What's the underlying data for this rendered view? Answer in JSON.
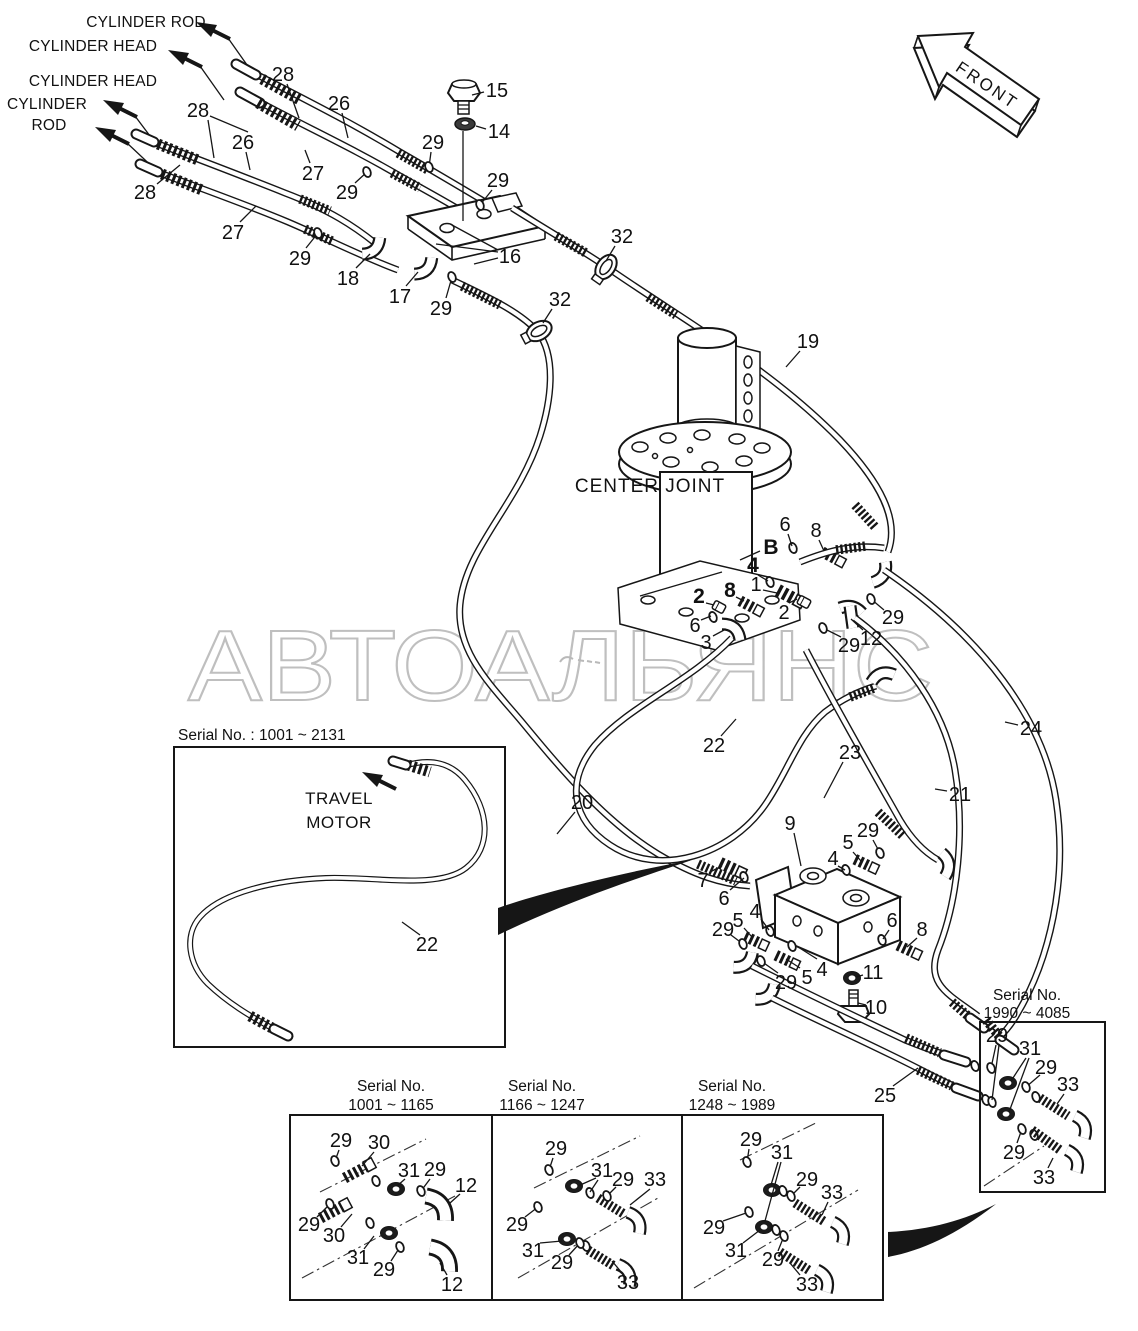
{
  "watermark": {
    "text": "АВТОАЛЬЯНС",
    "color": "#bfbfbf"
  },
  "front_arrow": {
    "label": "FRONT"
  },
  "labels": {
    "center_joint": "CENTER JOINT",
    "travel_motor_1": "TRAVEL",
    "travel_motor_2": "MOTOR",
    "cyl_top_1": "CYLINDER ROD",
    "cyl_top_2": "CYLINDER HEAD",
    "cyl_left_1": "CYLINDER HEAD",
    "cyl_left_2": "CYLINDER",
    "cyl_left_3": "ROD"
  },
  "insets": {
    "travel": {
      "title": "Serial No. : 1001 ~ 2131"
    },
    "box1": {
      "title_1": "Serial No.",
      "title_2": "1001 ~ 1165"
    },
    "box2": {
      "title_1": "Serial No.",
      "title_2": "1166 ~ 1247"
    },
    "box3": {
      "title_1": "Serial No.",
      "title_2": "1248 ~ 1989"
    },
    "box4": {
      "title_1": "Serial No.",
      "title_2": "1990 ~ 4085"
    }
  },
  "callouts": [
    {
      "t": "28",
      "x": 283,
      "y": 74,
      "l": [
        [
          287,
          84,
          299,
          118
        ]
      ]
    },
    {
      "t": "26",
      "x": 339,
      "y": 103,
      "l": [
        [
          342,
          113,
          348,
          138
        ]
      ]
    },
    {
      "t": "15",
      "x": 497,
      "y": 90,
      "l": [
        [
          484,
          92,
          472,
          95
        ]
      ]
    },
    {
      "t": "14",
      "x": 499,
      "y": 131,
      "l": [
        [
          486,
          129,
          476,
          126
        ]
      ]
    },
    {
      "t": "29",
      "x": 433,
      "y": 142,
      "l": [
        [
          431,
          152,
          429,
          167
        ]
      ]
    },
    {
      "t": "28",
      "x": 198,
      "y": 110,
      "l": [
        [
          210,
          116,
          248,
          132
        ],
        [
          208,
          120,
          214,
          158
        ]
      ]
    },
    {
      "t": "26",
      "x": 243,
      "y": 142,
      "l": [
        [
          246,
          152,
          250,
          170
        ]
      ]
    },
    {
      "t": "27",
      "x": 313,
      "y": 173,
      "l": [
        [
          310,
          163,
          305,
          150
        ]
      ]
    },
    {
      "t": "29",
      "x": 347,
      "y": 192,
      "l": [
        [
          355,
          183,
          367,
          172
        ]
      ]
    },
    {
      "t": "29",
      "x": 498,
      "y": 180,
      "l": [
        [
          492,
          190,
          480,
          205
        ]
      ]
    },
    {
      "t": "28",
      "x": 145,
      "y": 192,
      "l": [
        [
          157,
          184,
          180,
          165
        ]
      ]
    },
    {
      "t": "27",
      "x": 233,
      "y": 232,
      "l": [
        [
          240,
          222,
          256,
          206
        ]
      ]
    },
    {
      "t": "29",
      "x": 300,
      "y": 258,
      "l": [
        [
          306,
          248,
          318,
          233
        ]
      ]
    },
    {
      "t": "16",
      "x": 510,
      "y": 256,
      "l": [
        [
          498,
          250,
          452,
          225
        ],
        [
          498,
          252,
          436,
          244
        ],
        [
          498,
          258,
          474,
          264
        ]
      ]
    },
    {
      "t": "18",
      "x": 348,
      "y": 278,
      "l": [
        [
          356,
          268,
          370,
          254
        ]
      ]
    },
    {
      "t": "17",
      "x": 400,
      "y": 296,
      "l": [
        [
          406,
          286,
          418,
          272
        ]
      ]
    },
    {
      "t": "29",
      "x": 441,
      "y": 308,
      "l": [
        [
          446,
          298,
          452,
          277
        ]
      ]
    },
    {
      "t": "32",
      "x": 622,
      "y": 236,
      "l": [
        [
          615,
          246,
          606,
          261
        ]
      ]
    },
    {
      "t": "32",
      "x": 560,
      "y": 299,
      "l": [
        [
          552,
          309,
          543,
          323
        ]
      ]
    },
    {
      "t": "19",
      "x": 808,
      "y": 341,
      "l": [
        [
          800,
          351,
          786,
          367
        ]
      ]
    },
    {
      "t": "6",
      "x": 785,
      "y": 524,
      "l": [
        [
          788,
          534,
          792,
          546
        ]
      ]
    },
    {
      "t": "8",
      "x": 816,
      "y": 530,
      "l": [
        [
          819,
          540,
          824,
          551
        ]
      ]
    },
    {
      "t": "B",
      "x": 771,
      "y": 547,
      "b": 1,
      "l": [
        [
          760,
          551,
          740,
          560
        ]
      ]
    },
    {
      "t": "4",
      "x": 753,
      "y": 565,
      "b": 1,
      "l": [
        [
          758,
          575,
          768,
          581
        ]
      ]
    },
    {
      "t": "1",
      "x": 756,
      "y": 584,
      "l": [
        [
          763,
          590,
          777,
          593
        ]
      ]
    },
    {
      "t": "2",
      "x": 784,
      "y": 612,
      "l": [
        [
          789,
          603,
          797,
          599
        ]
      ]
    },
    {
      "t": "8",
      "x": 730,
      "y": 590,
      "b": 1,
      "l": [
        [
          736,
          597,
          744,
          601
        ]
      ]
    },
    {
      "t": "2",
      "x": 699,
      "y": 596,
      "b": 1,
      "l": [
        [
          706,
          603,
          714,
          605
        ]
      ]
    },
    {
      "t": "6",
      "x": 695,
      "y": 625,
      "l": [
        [
          701,
          620,
          711,
          616
        ]
      ]
    },
    {
      "t": "3",
      "x": 706,
      "y": 642,
      "l": [
        [
          713,
          636,
          726,
          629
        ]
      ]
    },
    {
      "t": "29",
      "x": 893,
      "y": 617,
      "l": [
        [
          884,
          610,
          871,
          599
        ]
      ]
    },
    {
      "t": "12",
      "x": 871,
      "y": 638,
      "l": [
        [
          863,
          630,
          851,
          619
        ]
      ]
    },
    {
      "t": "29",
      "x": 849,
      "y": 645,
      "l": [
        [
          841,
          637,
          823,
          628
        ]
      ]
    },
    {
      "t": "24",
      "x": 1031,
      "y": 728,
      "l": [
        [
          1018,
          725,
          1005,
          722
        ]
      ]
    },
    {
      "t": "21",
      "x": 960,
      "y": 794,
      "l": [
        [
          947,
          791,
          935,
          789
        ]
      ]
    },
    {
      "t": "23",
      "x": 850,
      "y": 752,
      "l": [
        [
          843,
          762,
          824,
          798
        ]
      ]
    },
    {
      "t": "22",
      "x": 714,
      "y": 745,
      "l": [
        [
          721,
          736,
          736,
          719
        ]
      ]
    },
    {
      "t": "20",
      "x": 582,
      "y": 802,
      "l": [
        [
          575,
          812,
          557,
          834
        ]
      ]
    },
    {
      "t": "9",
      "x": 790,
      "y": 823,
      "l": [
        [
          794,
          833,
          801,
          866
        ]
      ]
    },
    {
      "t": "29",
      "x": 868,
      "y": 830,
      "l": [
        [
          873,
          840,
          880,
          853
        ]
      ]
    },
    {
      "t": "5",
      "x": 848,
      "y": 842,
      "l": [
        [
          853,
          852,
          861,
          861
        ]
      ]
    },
    {
      "t": "4",
      "x": 833,
      "y": 858,
      "l": [
        [
          838,
          866,
          845,
          870
        ]
      ]
    },
    {
      "t": "7",
      "x": 703,
      "y": 880,
      "l": [
        [
          710,
          872,
          722,
          866
        ]
      ]
    },
    {
      "t": "6",
      "x": 724,
      "y": 898,
      "l": [
        [
          730,
          890,
          744,
          878
        ]
      ]
    },
    {
      "t": "29",
      "x": 723,
      "y": 929,
      "l": [
        [
          731,
          935,
          743,
          944
        ]
      ]
    },
    {
      "t": "5",
      "x": 738,
      "y": 920,
      "l": [
        [
          744,
          928,
          752,
          937
        ]
      ]
    },
    {
      "t": "4",
      "x": 755,
      "y": 911,
      "l": [
        [
          761,
          919,
          769,
          930
        ]
      ]
    },
    {
      "t": "4",
      "x": 822,
      "y": 969,
      "l": [
        [
          817,
          959,
          798,
          947
        ]
      ]
    },
    {
      "t": "5",
      "x": 807,
      "y": 977,
      "l": [
        [
          800,
          968,
          786,
          959
        ]
      ]
    },
    {
      "t": "29",
      "x": 786,
      "y": 982,
      "l": [
        [
          778,
          973,
          761,
          961
        ]
      ]
    },
    {
      "t": "6",
      "x": 892,
      "y": 920,
      "l": [
        [
          889,
          930,
          883,
          939
        ]
      ]
    },
    {
      "t": "8",
      "x": 922,
      "y": 929,
      "l": [
        [
          917,
          938,
          907,
          947
        ]
      ]
    },
    {
      "t": "11",
      "x": 873,
      "y": 972,
      "l": [
        [
          863,
          975,
          856,
          977
        ]
      ]
    },
    {
      "t": "10",
      "x": 876,
      "y": 1007,
      "l": [
        [
          866,
          1005,
          858,
          1003
        ]
      ]
    },
    {
      "t": "25",
      "x": 885,
      "y": 1095,
      "l": [
        [
          893,
          1086,
          918,
          1068
        ]
      ]
    },
    {
      "t": "22",
      "x": 427,
      "y": 944,
      "l": [
        [
          420,
          935,
          402,
          922
        ]
      ]
    },
    {
      "t": "29",
      "x": 341,
      "y": 1140,
      "l": [
        [
          339,
          1150,
          335,
          1161
        ]
      ]
    },
    {
      "t": "30",
      "x": 379,
      "y": 1142,
      "l": [
        [
          374,
          1152,
          362,
          1166
        ]
      ]
    },
    {
      "t": "31",
      "x": 409,
      "y": 1170,
      "l": [
        [
          405,
          1179,
          397,
          1186
        ]
      ]
    },
    {
      "t": "29",
      "x": 435,
      "y": 1169,
      "l": [
        [
          430,
          1179,
          421,
          1191
        ]
      ]
    },
    {
      "t": "12",
      "x": 466,
      "y": 1185,
      "l": [
        [
          460,
          1194,
          450,
          1203
        ]
      ]
    },
    {
      "t": "29",
      "x": 309,
      "y": 1224,
      "l": [
        [
          317,
          1217,
          330,
          1204
        ]
      ]
    },
    {
      "t": "30",
      "x": 334,
      "y": 1235,
      "l": [
        [
          341,
          1227,
          352,
          1214
        ]
      ]
    },
    {
      "t": "31",
      "x": 358,
      "y": 1257,
      "l": [
        [
          364,
          1249,
          374,
          1236
        ]
      ]
    },
    {
      "t": "29",
      "x": 384,
      "y": 1269,
      "l": [
        [
          391,
          1261,
          400,
          1247
        ]
      ]
    },
    {
      "t": "12",
      "x": 452,
      "y": 1284,
      "l": [
        [
          447,
          1275,
          440,
          1263
        ]
      ]
    },
    {
      "t": "29",
      "x": 556,
      "y": 1148,
      "l": [
        [
          553,
          1158,
          549,
          1170
        ]
      ]
    },
    {
      "t": "31",
      "x": 602,
      "y": 1170,
      "l": [
        [
          596,
          1178,
          578,
          1186
        ],
        [
          598,
          1180,
          590,
          1192
        ]
      ]
    },
    {
      "t": "29",
      "x": 623,
      "y": 1179,
      "l": [
        [
          616,
          1187,
          607,
          1196
        ]
      ]
    },
    {
      "t": "33",
      "x": 655,
      "y": 1179,
      "l": [
        [
          650,
          1189,
          630,
          1205
        ]
      ]
    },
    {
      "t": "29",
      "x": 517,
      "y": 1224,
      "l": [
        [
          525,
          1217,
          538,
          1207
        ]
      ]
    },
    {
      "t": "31",
      "x": 533,
      "y": 1250,
      "l": [
        [
          540,
          1243,
          562,
          1241
        ]
      ]
    },
    {
      "t": "29",
      "x": 562,
      "y": 1262,
      "l": [
        [
          569,
          1255,
          580,
          1243
        ]
      ]
    },
    {
      "t": "33",
      "x": 628,
      "y": 1282,
      "l": [
        [
          622,
          1273,
          612,
          1261
        ]
      ]
    },
    {
      "t": "29",
      "x": 751,
      "y": 1139,
      "l": [
        [
          749,
          1149,
          747,
          1162
        ]
      ]
    },
    {
      "t": "31",
      "x": 782,
      "y": 1152,
      "l": [
        [
          778,
          1162,
          771,
          1185
        ],
        [
          781,
          1162,
          765,
          1221
        ]
      ]
    },
    {
      "t": "29",
      "x": 807,
      "y": 1179,
      "l": [
        [
          800,
          1187,
          791,
          1196
        ]
      ]
    },
    {
      "t": "33",
      "x": 832,
      "y": 1192,
      "l": [
        [
          828,
          1202,
          822,
          1215
        ]
      ]
    },
    {
      "t": "29",
      "x": 714,
      "y": 1227,
      "l": [
        [
          723,
          1221,
          749,
          1212
        ]
      ]
    },
    {
      "t": "31",
      "x": 736,
      "y": 1250,
      "l": [
        [
          743,
          1243,
          760,
          1230
        ]
      ]
    },
    {
      "t": "29",
      "x": 773,
      "y": 1259,
      "l": [
        [
          778,
          1251,
          784,
          1236
        ]
      ]
    },
    {
      "t": "33",
      "x": 807,
      "y": 1284,
      "l": [
        [
          800,
          1275,
          790,
          1263
        ]
      ]
    },
    {
      "t": "29",
      "x": 997,
      "y": 1035,
      "l": [
        [
          996,
          1045,
          991,
          1068
        ],
        [
          999,
          1045,
          992,
          1100
        ]
      ]
    },
    {
      "t": "31",
      "x": 1030,
      "y": 1048,
      "l": [
        [
          1026,
          1058,
          1011,
          1081
        ],
        [
          1029,
          1058,
          1009,
          1112
        ]
      ]
    },
    {
      "t": "29",
      "x": 1046,
      "y": 1067,
      "l": [
        [
          1040,
          1075,
          1026,
          1087
        ]
      ]
    },
    {
      "t": "33",
      "x": 1068,
      "y": 1084,
      "l": [
        [
          1064,
          1094,
          1057,
          1104
        ]
      ]
    },
    {
      "t": "29",
      "x": 1014,
      "y": 1152,
      "l": [
        [
          1017,
          1143,
          1022,
          1129
        ]
      ]
    },
    {
      "t": "33",
      "x": 1044,
      "y": 1177,
      "l": [
        [
          1048,
          1168,
          1053,
          1158
        ]
      ]
    }
  ]
}
